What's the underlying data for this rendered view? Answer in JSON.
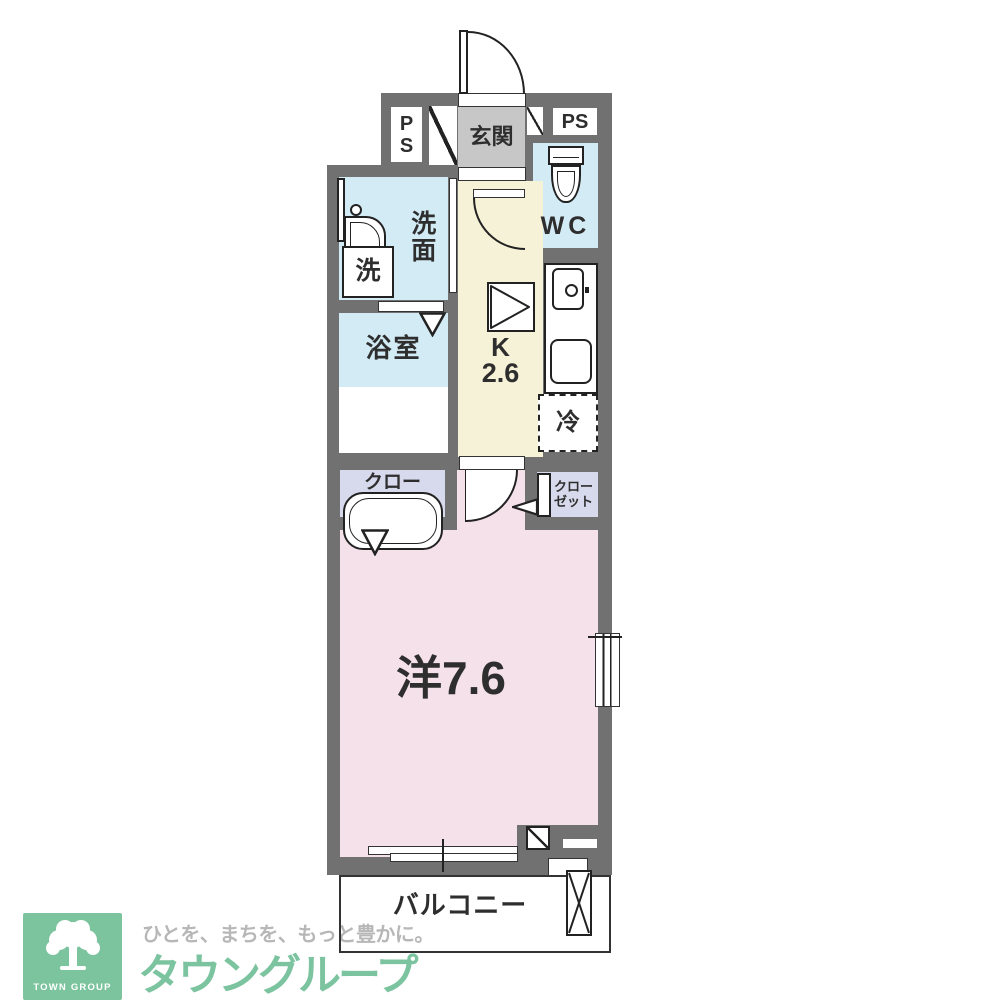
{
  "floorplan": {
    "unit_labels": {
      "ps_left": "PS",
      "ps_right": "PS",
      "entrance": "玄関",
      "wc": "WC",
      "washroom": "洗面",
      "washing_machine": "洗",
      "bathroom": "浴室",
      "kitchen_letter": "K",
      "kitchen_size": "2.6",
      "refrigerator": "冷",
      "closet_left_line1": "クロー",
      "closet_left_line2": "ゼット",
      "closet_right_line1": "クロー",
      "closet_right_line2": "ゼット",
      "main_room": "洋7.6",
      "balcony": "バルコニー"
    },
    "colors": {
      "wall": "#717171",
      "water_rooms": "#d3ebf4",
      "kitchen": "#f6f2d7",
      "closet": "#d7d9ec",
      "western_room": "#f5e1ea",
      "entrance_floor": "#c7c7c7",
      "line": "#222222"
    }
  },
  "logo": {
    "box_text": "TOWN GROUP",
    "tagline": "ひとを、まちを、もっと豊かに。",
    "brand": "タウングループ",
    "colors": {
      "box_green": "#7cc49e",
      "brand_green": "#7cc4a0",
      "tagline_gray": "#b7b7b7"
    }
  }
}
